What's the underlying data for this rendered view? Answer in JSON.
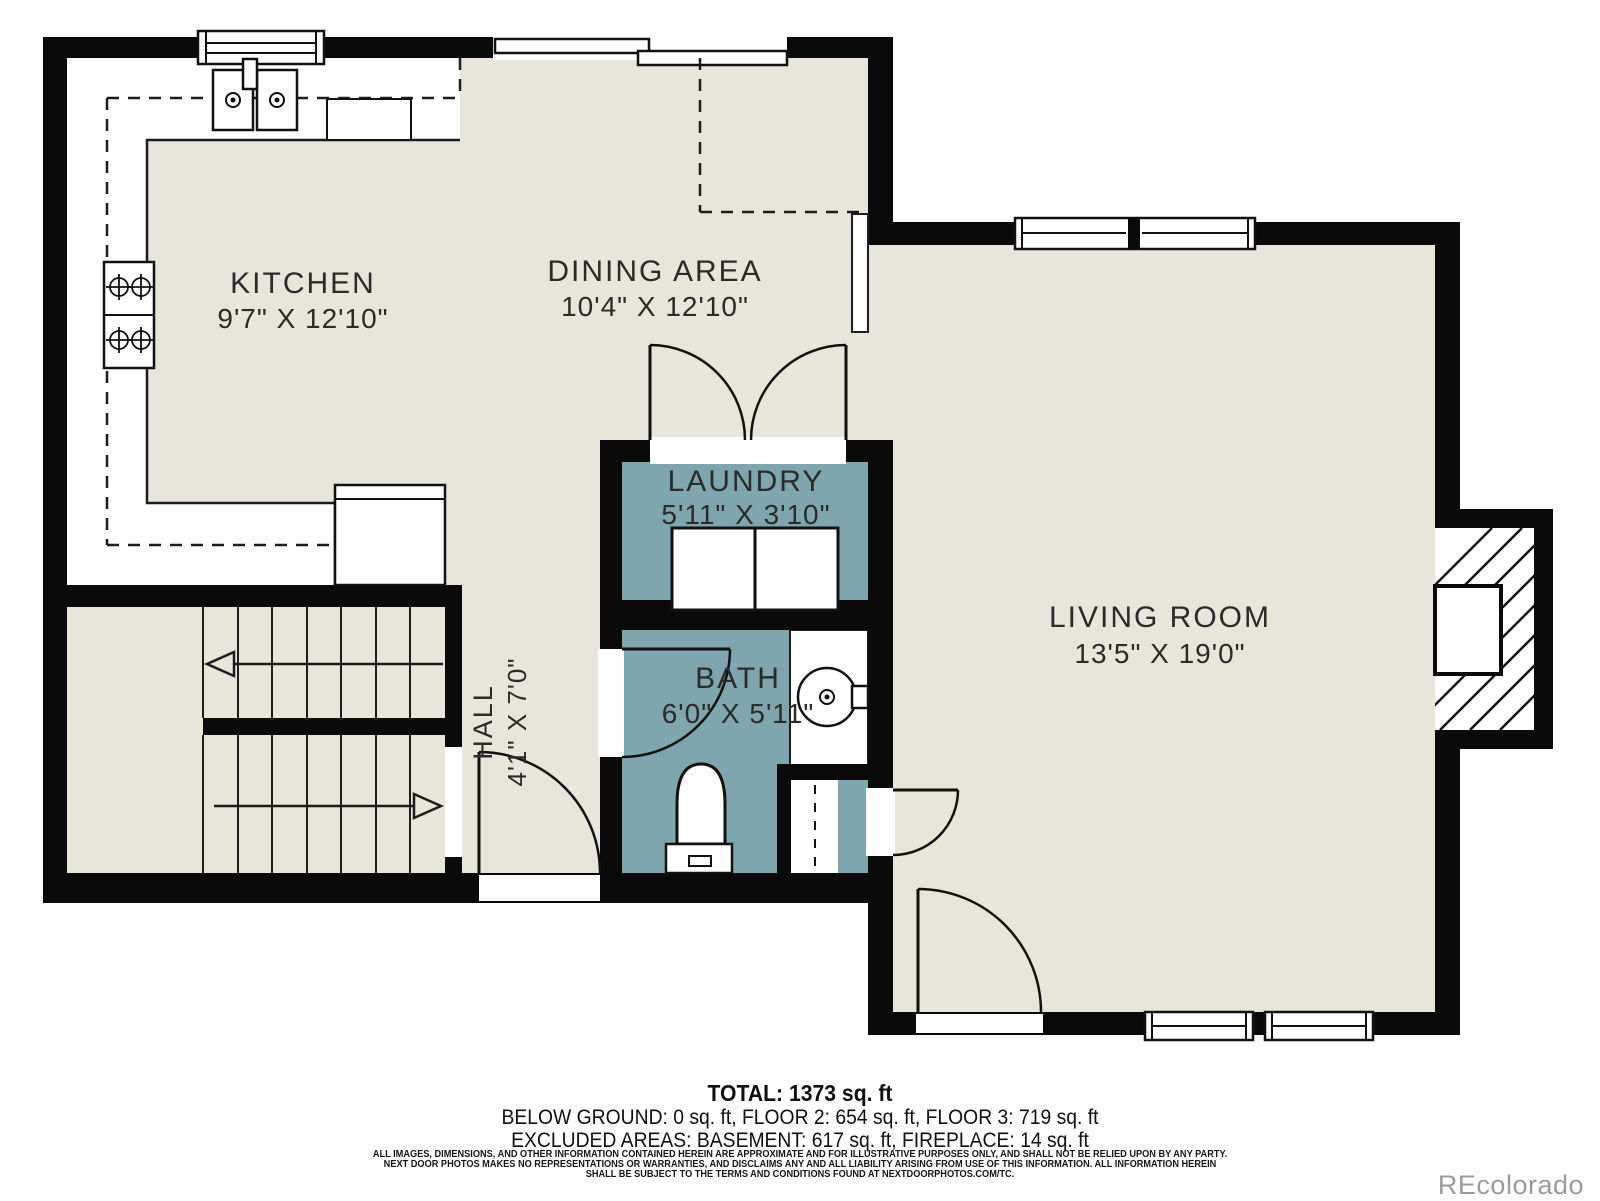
{
  "colors": {
    "wall": "#0a0a0a",
    "floor": "#e8e6db",
    "wet_room": "#7fa6ae",
    "line": "#1c1c1c",
    "watermark_gray": "#9b9b9b"
  },
  "rooms": {
    "kitchen": {
      "label": "KITCHEN",
      "dims": "9'7\" X 12'10\""
    },
    "dining": {
      "label": "DINING AREA",
      "dims": "10'4\" X 12'10\""
    },
    "laundry": {
      "label": "LAUNDRY",
      "dims": "5'11\" X 3'10\""
    },
    "bath": {
      "label": "BATH",
      "dims": "6'0\" X 5'11\""
    },
    "hall": {
      "label": "HALL",
      "dims": "4'1\" X 7'0\""
    },
    "living": {
      "label": "LIVING ROOM",
      "dims": "13'5\" X 19'0\""
    }
  },
  "summary": {
    "total": "TOTAL: 1373 sq. ft",
    "floors": "BELOW GROUND: 0 sq. ft, FLOOR 2: 654 sq. ft, FLOOR 3: 719 sq. ft",
    "excluded": "EXCLUDED AREAS: BASEMENT: 617 sq. ft, FIREPLACE: 14 sq. ft"
  },
  "disclaimer": {
    "line1": "ALL IMAGES, DIMENSIONS, AND OTHER INFORMATION CONTAINED HEREIN ARE APPROXIMATE AND FOR ILLUSTRATIVE PURPOSES ONLY, AND SHALL NOT BE RELIED UPON BY ANY PARTY.",
    "line2": "NEXT DOOR PHOTOS MAKES NO REPRESENTATIONS OR WARRANTIES, AND DISCLAIMS ANY AND ALL LIABILITY ARISING FROM USE OF THIS INFORMATION. ALL INFORMATION HEREIN",
    "line3": "SHALL BE SUBJECT TO THE TERMS AND CONDITIONS FOUND AT NEXTDOORPHOTOS.COM/TC."
  },
  "watermark": "REcolorado"
}
